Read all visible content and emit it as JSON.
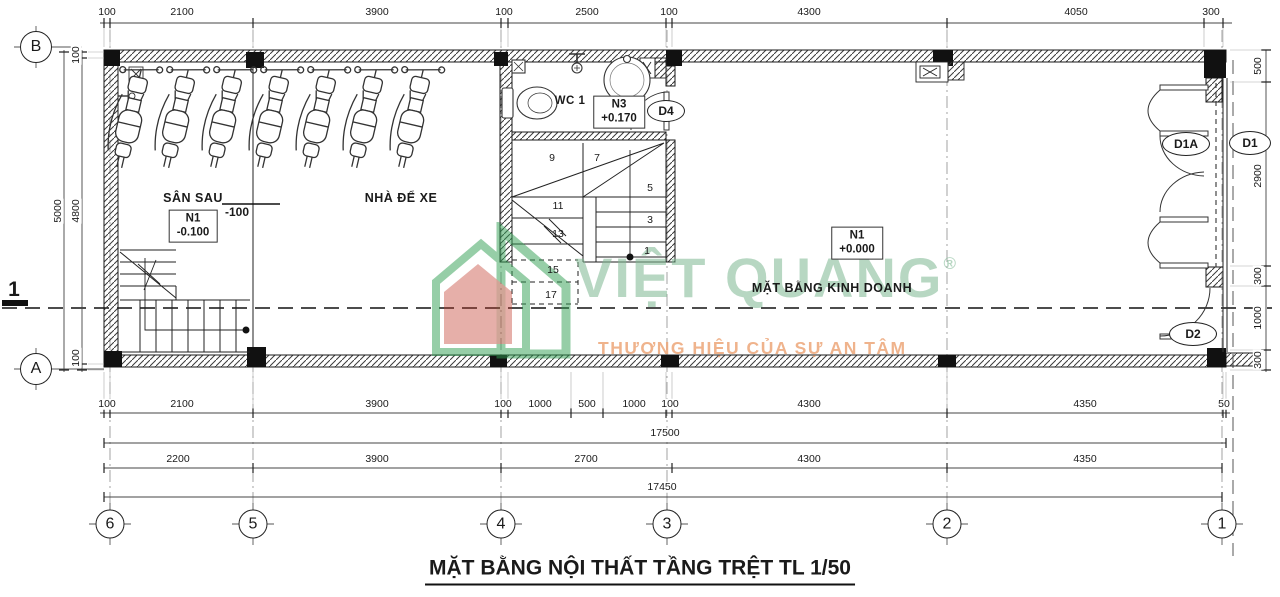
{
  "title": "MẶT BẰNG NỘI THẤT TẦNG TRỆT TL 1/50",
  "watermark": {
    "brand": "VIỆT QUANG",
    "reg": "®",
    "tagline": "THƯƠNG HIỆU CỦA SỰ AN TÂM"
  },
  "rooms": {
    "san_sau": {
      "label": "SÂN SAU",
      "level_mark": "-100"
    },
    "garage": {
      "label": "NHÀ ĐỂ XE"
    },
    "wc": {
      "label": "WC 1"
    },
    "shop": {
      "label": "MẶT BẰNG KINH DOANH"
    }
  },
  "level_boxes": [
    {
      "tag": "N1",
      "value": "-0.100",
      "x": 193,
      "y": 226
    },
    {
      "tag": "N3",
      "value": "+0.170",
      "x": 619,
      "y": 112
    },
    {
      "tag": "N1",
      "value": "+0.000",
      "x": 857,
      "y": 243
    }
  ],
  "doors": [
    {
      "id": "D4",
      "x": 666,
      "y": 111,
      "w": 36,
      "h": 20
    },
    {
      "id": "D1A",
      "x": 1186,
      "y": 144,
      "w": 46,
      "h": 22
    },
    {
      "id": "D1",
      "x": 1250,
      "y": 143,
      "w": 40,
      "h": 22
    },
    {
      "id": "D2",
      "x": 1193,
      "y": 334,
      "w": 46,
      "h": 22
    }
  ],
  "grid": {
    "cols": [
      {
        "label": "6",
        "x": 110
      },
      {
        "label": "5",
        "x": 253
      },
      {
        "label": "4",
        "x": 501
      },
      {
        "label": "3",
        "x": 667
      },
      {
        "label": "2",
        "x": 947
      },
      {
        "label": "1",
        "x": 1222
      }
    ],
    "cols_y": 524,
    "rows": [
      {
        "label": "B",
        "x": 36,
        "y": 47
      },
      {
        "label": "A",
        "x": 36,
        "y": 369
      }
    ]
  },
  "section_marker": {
    "label": "1"
  },
  "stair_treads": [
    {
      "t": "9",
      "x": 552,
      "y": 158
    },
    {
      "t": "7",
      "x": 597,
      "y": 158
    },
    {
      "t": "5",
      "x": 650,
      "y": 188
    },
    {
      "t": "3",
      "x": 650,
      "y": 220
    },
    {
      "t": "1",
      "x": 647,
      "y": 251
    },
    {
      "t": "11",
      "x": 558,
      "y": 206
    },
    {
      "t": "13",
      "x": 558,
      "y": 234
    },
    {
      "t": "15",
      "x": 553,
      "y": 270
    },
    {
      "t": "17",
      "x": 551,
      "y": 295
    }
  ],
  "dims": {
    "top": {
      "y": 12,
      "items": [
        {
          "t": "100",
          "x": 107
        },
        {
          "t": "2100",
          "x": 182
        },
        {
          "t": "3900",
          "x": 377
        },
        {
          "t": "100",
          "x": 504
        },
        {
          "t": "2500",
          "x": 587
        },
        {
          "t": "100",
          "x": 669
        },
        {
          "t": "4300",
          "x": 809
        },
        {
          "t": "4050",
          "x": 1076
        },
        {
          "t": "300",
          "x": 1211
        }
      ]
    },
    "row_a": {
      "y": 404,
      "items": [
        {
          "t": "100",
          "x": 107
        },
        {
          "t": "2100",
          "x": 182
        },
        {
          "t": "3900",
          "x": 377
        },
        {
          "t": "100",
          "x": 503
        },
        {
          "t": "1000",
          "x": 540
        },
        {
          "t": "500",
          "x": 587
        },
        {
          "t": "1000",
          "x": 634
        },
        {
          "t": "100",
          "x": 670
        },
        {
          "t": "4300",
          "x": 809
        },
        {
          "t": "4350",
          "x": 1085
        },
        {
          "t": "50",
          "x": 1224
        }
      ]
    },
    "total_a": {
      "t": "17500",
      "x": 665,
      "y": 433
    },
    "row_b": {
      "y": 459,
      "items": [
        {
          "t": "2200",
          "x": 178
        },
        {
          "t": "3900",
          "x": 377
        },
        {
          "t": "2700",
          "x": 586
        },
        {
          "t": "4300",
          "x": 809
        },
        {
          "t": "4350",
          "x": 1085
        }
      ]
    },
    "total_b": {
      "t": "17450",
      "x": 662,
      "y": 487
    },
    "left": [
      {
        "t": "5000",
        "x": 58,
        "y": 211
      },
      {
        "t": "100",
        "x": 76,
        "y": 55
      },
      {
        "t": "4800",
        "x": 76,
        "y": 211
      },
      {
        "t": "100",
        "x": 76,
        "y": 358
      }
    ],
    "right": [
      {
        "t": "500",
        "x": 1258,
        "y": 66
      },
      {
        "t": "2900",
        "x": 1258,
        "y": 176
      },
      {
        "t": "300",
        "x": 1258,
        "y": 276
      },
      {
        "t": "1000",
        "x": 1258,
        "y": 318
      },
      {
        "t": "300",
        "x": 1258,
        "y": 360
      }
    ]
  },
  "bike_count": 7,
  "colors": {
    "line": "#1a1a1a",
    "wm_green": "#7db792",
    "wm_orange": "#eda679",
    "wm_logo_green": "#2f9e52",
    "wm_logo_red": "#c0392b"
  }
}
